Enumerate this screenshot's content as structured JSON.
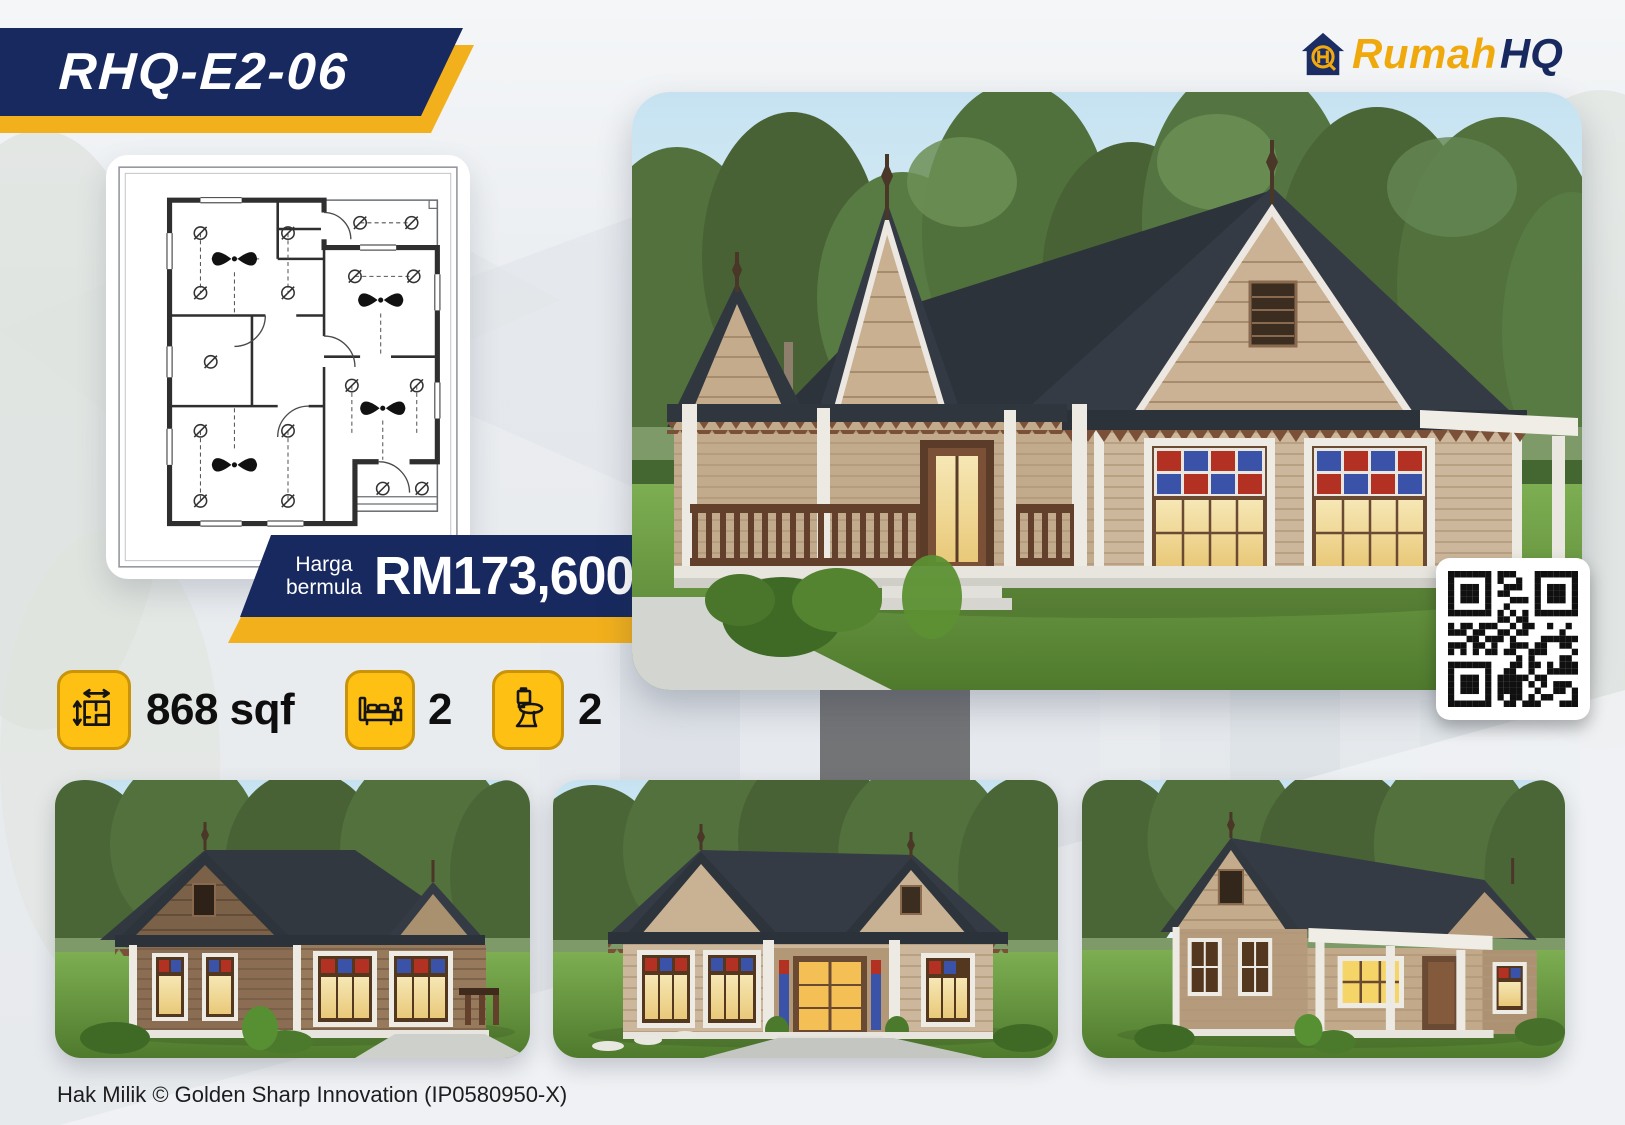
{
  "header": {
    "model_code": "RHQ-E2-06",
    "logo": {
      "icon": "rumahhq-house-logo-icon",
      "brand": "Rumah",
      "brand_suffix": "HQ"
    }
  },
  "price": {
    "label_line1": "Harga",
    "label_line2": "bermula",
    "value": "RM173,600"
  },
  "specs": [
    {
      "name": "floor-area",
      "icon": "floor-area-icon",
      "value": "868 sqf"
    },
    {
      "name": "bedrooms",
      "icon": "bed-icon",
      "value": "2"
    },
    {
      "name": "bathrooms",
      "icon": "toilet-icon",
      "value": "2"
    }
  ],
  "images": {
    "floor_plan": "electrical-floor-plan-drawing",
    "main_render": "house-render-front-left",
    "thumbnails": [
      "house-render-side-view",
      "house-render-front-view",
      "house-render-rear-view"
    ],
    "qr_code": "qr-code"
  },
  "footer": {
    "copyright": "Hak Milik © Golden Sharp Innovation (IP0580950-X)"
  },
  "colors": {
    "navy": "#17295e",
    "gold": "#f2b01c",
    "icon_gold": "#fdc013",
    "stained_red": "#b23122",
    "stained_blue": "#3a53a8",
    "roof": "#343b44",
    "siding_tan": "#cdb79c"
  }
}
